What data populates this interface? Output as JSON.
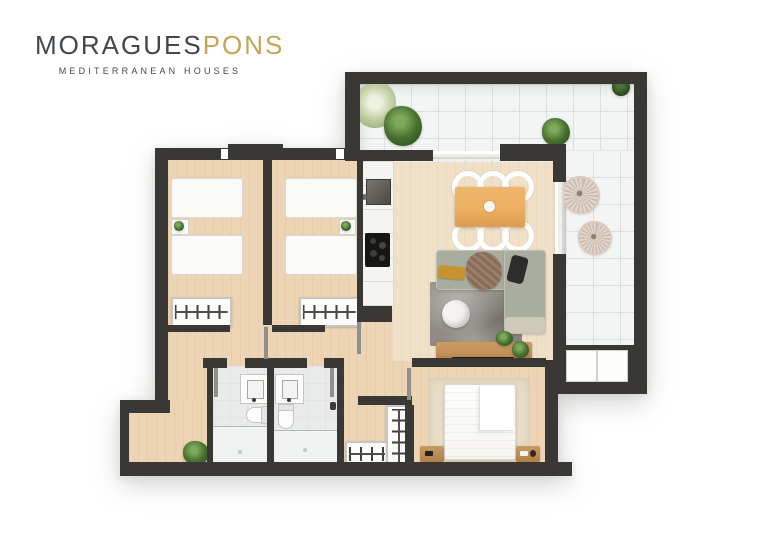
{
  "branding": {
    "name_primary": "MORAGUES",
    "name_accent": "PONS",
    "tagline": "MEDITERRANEAN HOUSES"
  },
  "palette": {
    "background": "#ffffff",
    "wall": "#3a3835",
    "wood": "#ecd4b4",
    "wood_light": "#f1e0c8",
    "tile": "#f3f5f4",
    "tile_line": "#dcdfdd",
    "bath": "#e9ebea",
    "shower": "#f0f2f1",
    "counter": "#f4f4f2",
    "fixture": "#fcfcfb",
    "sofa": "#a9ad9f",
    "rug": "#8f8b84",
    "rug_master": "#e8dcc6",
    "table_wood": "#ecaf63",
    "console_wood": "#c3905a",
    "blanket": "#958e71",
    "plant": "#47702f",
    "wicker": "#e4d9cf",
    "accent_gold": "#c4a557",
    "logo_text": "#43474c",
    "door": "#8f8f8c"
  },
  "floorplan": {
    "rooms": [
      "terrace",
      "living-dining-room",
      "kitchen",
      "bedroom-1",
      "bedroom-2",
      "hallway",
      "bathroom-1",
      "bathroom-2",
      "walk-in-closet",
      "master-bedroom",
      "entry"
    ],
    "furniture": [
      "twin-beds",
      "wardrobe-racks",
      "dining-table-six-chairs",
      "corner-sofa",
      "coffee-table",
      "tv-console",
      "double-bed",
      "nightstands",
      "terrace-plants",
      "wicker-chairs",
      "storage-bench",
      "toilets",
      "vanities",
      "showers"
    ]
  }
}
